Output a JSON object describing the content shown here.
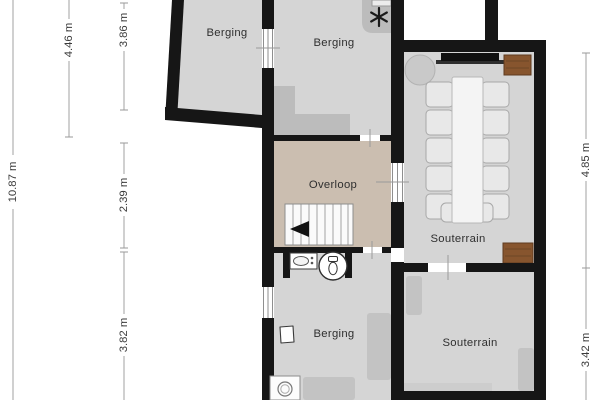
{
  "title": "Floor plan - souterrain level",
  "rooms": [
    {
      "id": "berging-top-left",
      "label": "Berging"
    },
    {
      "id": "berging-top",
      "label": "Berging"
    },
    {
      "id": "overloop",
      "label": "Overloop"
    },
    {
      "id": "souterrain-upper",
      "label": "Souterrain"
    },
    {
      "id": "berging-lower",
      "label": "Berging"
    },
    {
      "id": "souterrain-lower",
      "label": "Souterrain"
    }
  ],
  "dimensions": {
    "left": [
      {
        "label": "10.87 m"
      },
      {
        "label": "4.46 m"
      },
      {
        "label": "3.86 m"
      },
      {
        "label": "2.39 m"
      },
      {
        "label": "3.82 m"
      }
    ],
    "right": [
      {
        "label": "4.85 m"
      },
      {
        "label": "3.42 m"
      }
    ]
  },
  "icons": {
    "boiler": "asterisk-icon",
    "toilet": "toilet-icon",
    "sink": "sink-icon",
    "hand-basin": "hand-basin-icon",
    "washing-machine": "washing-machine-icon",
    "stairs": "staircase-with-arrow"
  },
  "colors": {
    "background": "#ffffff",
    "wall": "#161616",
    "floor": "#d5d5d5",
    "landing": "#cbbeb0",
    "dark_patch": "#bcbcbc",
    "furniture": "#c3c3c3",
    "wood": "#87552e",
    "dimension_line": "#a0a0a0",
    "label_text": "#2f2f2f"
  }
}
